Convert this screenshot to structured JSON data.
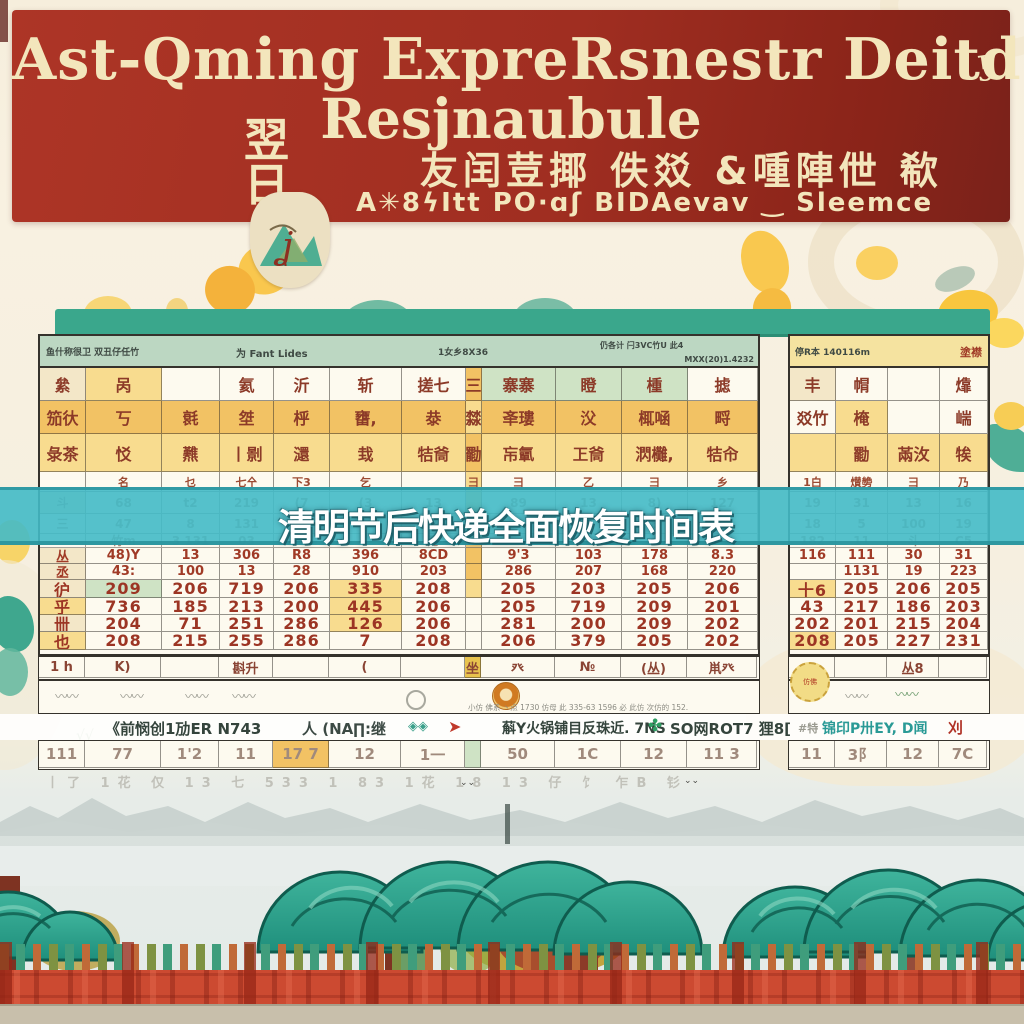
{
  "banner": {
    "line1": "Ast-Qming ExpreRsnestr Deitde",
    "line1_mark": "ʖ",
    "line2": "Resjnaubule",
    "stamp": "翌日",
    "line3": "友闰荳揶 佚㸚 &喠陣伳 欷",
    "line4": "A✳8ϟItt PO·ɑʃ BIDAevav ‿ Sleemce"
  },
  "overlay_title": "清明节后快递全面恢复时间表",
  "main_table": {
    "header": {
      "left": "鱼什称很卫  双丑仔任竹",
      "mid": "为 Fant Lides",
      "mid2": "1女乡8X36",
      "right": "仍各计 闩3VC竹U 此4",
      "far_right": "MXX(20)1.4232"
    },
    "rows": [
      {
        "t": "g",
        "h": 33,
        "bg": "w",
        "c": [
          "絫|c",
          "呙|y",
          "",
          "氦",
          "沂",
          "斩",
          "搓七",
          "三|o",
          "寨寨|g",
          "瞪|g",
          "㮔|g",
          "摅"
        ]
      },
      {
        "t": "g",
        "h": 33,
        "bg": "o",
        "c": [
          "笳㣕",
          "丂",
          "㲤",
          "㘶",
          "㭔",
          "㽫,",
          "㳟",
          "㵘|y",
          "㪯㻲",
          "㳇",
          "㭯㖤",
          "㽟"
        ]
      },
      {
        "t": "g",
        "h": 38,
        "bg": "y",
        "c": [
          "彔茶",
          "㤊",
          "㸐",
          "丨㔀",
          "㶎",
          "㦳",
          "㸵㸗",
          "㔥|o",
          "㠵㲷",
          "㠪㸗",
          "㴸㰙,",
          "㸵㠳"
        ]
      },
      {
        "t": "s",
        "h": 20,
        "bg": "w",
        "c": [
          "",
          "名",
          "乜",
          "七㐃",
          "下3",
          "乞",
          "",
          "彐|y",
          "彐",
          "乙",
          "彐",
          "乡"
        ]
      },
      {
        "t": "f",
        "h": 22,
        "bg": "w",
        "c": [
          "斗|c",
          "68",
          "t2",
          "219",
          "(7",
          "(3",
          "13",
          "|o",
          "89",
          "13",
          "8)",
          "127"
        ]
      },
      {
        "t": "f",
        "h": 20,
        "bg": "w",
        "c": [
          "三",
          "47",
          "8",
          "131",
          "806",
          "",
          "137",
          "|o",
          "7",
          "3",
          "8",
          "7"
        ]
      },
      {
        "t": "f",
        "h": 14,
        "bg": "w",
        "c": [
          "",
          "竹m",
          "3 131",
          "03",
          "166",
          "",
          "乃",
          "|o",
          "",
          "9",
          "",
          ""
        ]
      },
      {
        "t": "n",
        "h": 16,
        "bg": "w",
        "c": [
          "丛|c",
          "48)Y",
          "13",
          "306",
          "R8",
          "396",
          "8CD",
          "|o",
          "9'3",
          "103",
          "178",
          "8.3"
        ]
      },
      {
        "t": "n",
        "h": 16,
        "bg": "w",
        "c": [
          "丞|c",
          "43:",
          "100",
          "13",
          "28",
          "910",
          "203",
          "|o",
          "286",
          "207",
          "168",
          "220"
        ]
      },
      {
        "t": "nb",
        "h": 18,
        "bg": "w",
        "c": [
          "㣗|c",
          "209|g",
          "206",
          "719",
          "206",
          "335|y",
          "208",
          "|y",
          "205",
          "203",
          "205",
          "206"
        ]
      },
      {
        "t": "nb",
        "h": 17,
        "bg": "w",
        "c": [
          "乎|y",
          "736",
          "185",
          "213",
          "200",
          "445|y",
          "206",
          "",
          "205",
          "719",
          "209",
          "201"
        ]
      },
      {
        "t": "nb",
        "h": 17,
        "bg": "w",
        "c": [
          "卌|c",
          "204",
          "71",
          "251",
          "286",
          "126|y",
          "206",
          "",
          "281",
          "200",
          "209",
          "202"
        ]
      },
      {
        "t": "nb",
        "h": 18,
        "bg": "w",
        "c": [
          "也|y",
          "208",
          "215",
          "255",
          "286",
          "7",
          "208",
          "",
          "206",
          "379",
          "205",
          "202"
        ]
      }
    ]
  },
  "side_table": {
    "header": {
      "left": "停R本 140116m",
      "right": "塗襟"
    },
    "rows": [
      {
        "t": "g",
        "h": 33,
        "bg": "w",
        "c": [
          "丰|c",
          "㡌",
          "",
          "㸆"
        ]
      },
      {
        "t": "g",
        "h": 33,
        "bg": "w",
        "c": [
          "㸚竹",
          "㭺|y",
          "",
          "㟨"
        ]
      },
      {
        "t": "g",
        "h": 38,
        "bg": "y",
        "c": [
          "",
          "㔥",
          "㒼㳊",
          "㸻"
        ]
      },
      {
        "t": "s",
        "h": 20,
        "bg": "w",
        "c": [
          "1白",
          "㸇㔢",
          "彐",
          "乃"
        ]
      },
      {
        "t": "f",
        "h": 22,
        "bg": "w",
        "c": [
          "19",
          "31",
          "13",
          "16"
        ]
      },
      {
        "t": "f",
        "h": 20,
        "bg": "w",
        "c": [
          "18",
          "5",
          "100",
          "19"
        ]
      },
      {
        "t": "f",
        "h": 14,
        "bg": "w",
        "c": [
          "182",
          "11",
          "斗",
          "C5"
        ]
      },
      {
        "t": "n",
        "h": 16,
        "bg": "w",
        "c": [
          "116",
          "111",
          "30",
          "31"
        ]
      },
      {
        "t": "n",
        "h": 16,
        "bg": "w",
        "c": [
          "",
          "1131",
          "19",
          "223"
        ]
      },
      {
        "t": "nb",
        "h": 18,
        "bg": "w",
        "c": [
          "十6|y",
          "205",
          "206",
          "205"
        ]
      },
      {
        "t": "nb",
        "h": 17,
        "bg": "w",
        "c": [
          "43",
          "217",
          "186",
          "203"
        ]
      },
      {
        "t": "nb",
        "h": 17,
        "bg": "w",
        "c": [
          "202",
          "201",
          "215",
          "204"
        ]
      },
      {
        "t": "nb",
        "h": 18,
        "bg": "w",
        "c": [
          "208|y",
          "205",
          "227",
          "231"
        ]
      }
    ]
  },
  "footer": {
    "strip1": [
      {
        "t": "gf",
        "h": 21,
        "bg": "w",
        "c": [
          "1 h",
          "K)",
          "",
          "斟升",
          "",
          "(",
          "",
          "坐|d",
          "癶",
          "№",
          "(丛)",
          "鼡癶"
        ]
      }
    ],
    "side_strip1": [
      {
        "t": "gf",
        "h": 21,
        "bg": "w",
        "c": [
          "癶",
          "",
          "丛8",
          ""
        ]
      }
    ],
    "grid": [
      {
        "t": "fg",
        "h": 27,
        "bg": "w",
        "c": [
          "111",
          "77",
          "1'2",
          "11",
          "17 7|o",
          "12",
          "1一",
          "|g",
          "50",
          "1C",
          "12",
          "11 3"
        ]
      }
    ],
    "side_grid": [
      {
        "t": "fg",
        "h": 27,
        "bg": "w",
        "c": [
          "11",
          "3阝",
          "12",
          "7C"
        ]
      }
    ],
    "doodles": "〰〰",
    "tiny_caption": "小仿 佛系 丶点 1730 仿母 此 335-63 1596 必 此仿 次仿的 152.",
    "stamp2_text": "仿佛",
    "logo_line": {
      "left1": "《前悯创1劢ER N743",
      "left2": "人 (NA∏:继",
      "left2_marks": "◈◈",
      "arrow": "➤",
      "right1": "蔛Y火锅铺目反珠近. 7NS",
      "logo_mark": "✤",
      "right2": "SO网ROT7 狸8[",
      "side_gray": "#特",
      "side_main": "锦印P卅EY, D闻",
      "side_red": "刈"
    },
    "faint_line": "丨了 1花 仅 13 七 533 1 83 1花 18 13 仔 饣 乍B 钐"
  },
  "scenery": {
    "bird": "⌄⌄",
    "grass": "√√"
  },
  "colors": {
    "banner_red": "#a02e21",
    "banner_cream": "#f3e6bc",
    "band_cyan": "#42bac6",
    "tealbar": "#3aa78c",
    "cell_orange": "#f2c264",
    "cell_yellow": "#f8dc8f",
    "cell_green": "#cfe3c5",
    "glyph_red": "#9c3524",
    "tree_teal": "#2aa08d",
    "fence_red": "#cc4a31"
  }
}
